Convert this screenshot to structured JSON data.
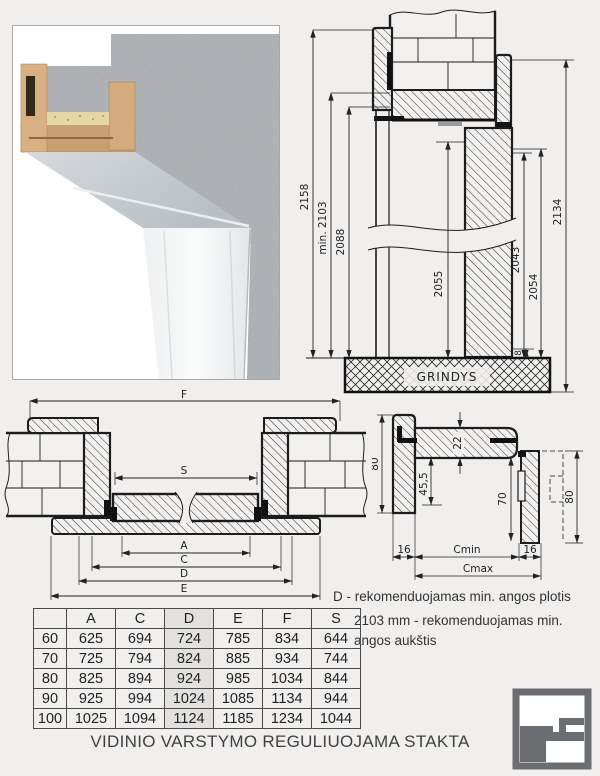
{
  "page": {
    "title": "VIDINIO VARSTYMO REGULIUOJAMA STAKTA"
  },
  "notes": {
    "width_note": "D - rekomenduojamas min. angos plotis",
    "height_note": "2103 mm - rekomenduojamas min. angos aukštis"
  },
  "vertical_section": {
    "floor_label": "GRINDYS",
    "dims": {
      "overall_height": "2158",
      "min_opening_height": "min. 2103",
      "frame_inner_height": "2088",
      "leaf_height_left": "2055",
      "leaf_height_right": "2043",
      "rebate_height": "2054",
      "frame_outer_height": "2134",
      "floor_gap": "8"
    }
  },
  "horizontal_section": {
    "dims": {
      "f": "F",
      "s": "S",
      "a": "A",
      "c": "C",
      "d": "D",
      "e": "E"
    }
  },
  "detail_section": {
    "dims": {
      "head_thickness": "22",
      "frame_depth_left": "80",
      "inner_left": "45,5",
      "inner_right": "70",
      "frame_depth_right": "80",
      "tab_left": "16",
      "c_min": "Cmin",
      "tab_right": "16",
      "c_max": "Cmax"
    }
  },
  "size_table": {
    "headers": [
      "",
      "A",
      "C",
      "D",
      "E",
      "F",
      "S"
    ],
    "highlight_column": "D",
    "rows": [
      [
        "60",
        "625",
        "694",
        "724",
        "785",
        "834",
        "644"
      ],
      [
        "70",
        "725",
        "794",
        "824",
        "885",
        "934",
        "744"
      ],
      [
        "80",
        "825",
        "894",
        "924",
        "985",
        "1034",
        "844"
      ],
      [
        "90",
        "925",
        "994",
        "1024",
        "1085",
        "1134",
        "944"
      ],
      [
        "100",
        "1025",
        "1094",
        "1124",
        "1185",
        "1234",
        "1044"
      ]
    ]
  },
  "colors": {
    "background": "#f0efee",
    "line": "#1c1c1c",
    "table_highlight": "#e2e1df",
    "logo_gray": "#6b6e70"
  }
}
